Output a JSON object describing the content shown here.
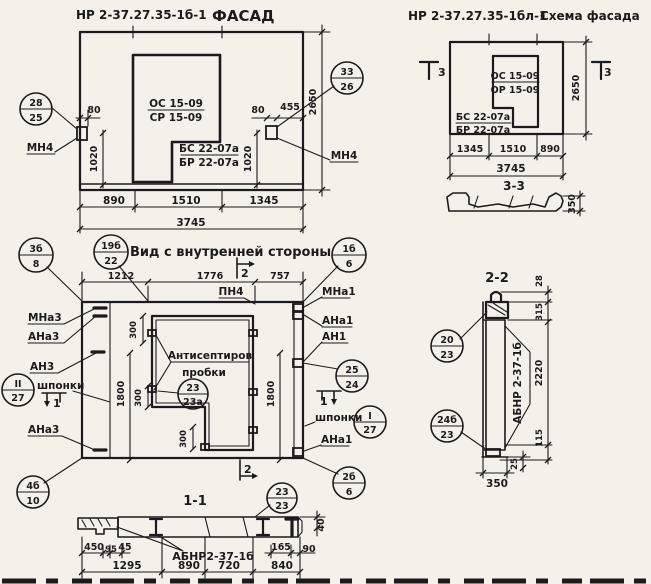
{
  "facade": {
    "mark": "НР 2-37.27.35-1б-1",
    "name": "ФАСАД",
    "win_a": "ОС 15-09",
    "win_b": "СР 15-09",
    "sill_a": "БС 22-07а",
    "sill_b": "БР 22-07а",
    "mn4_l": "МН4",
    "mn4_r": "МН4",
    "co_l_top": "28",
    "co_l_bot": "25",
    "co_r_top": "33",
    "co_r_bot": "26",
    "d80l": "80",
    "d1020l": "1020",
    "d80r": "80",
    "d455": "455",
    "d1020r": "1020",
    "d2650": "2650",
    "d890": "890",
    "d1510": "1510",
    "d1345": "1345",
    "d3745": "3745"
  },
  "scheme": {
    "mark": "НР 2-37.27.35-1бл-1",
    "name": "Схема фасада",
    "win_a": "ОС 15-09",
    "win_b": "ОР 15-09",
    "sill_a": "БС 22-07а",
    "sill_b": "БР 22-07а",
    "sec3": "3",
    "d2650": "2650",
    "d1345": "1345",
    "d1510": "1510",
    "d890": "890",
    "d3745": "3745"
  },
  "s33": {
    "title": "3-3",
    "d350": "350"
  },
  "inner": {
    "title": "Вид с внутренней стороны",
    "co_tl_top": "3б",
    "co_tl_bot": "8",
    "co_tm_top": "19б",
    "co_tm_bot": "22",
    "co_tr_top": "1б",
    "co_tr_bot": "6",
    "co_r_top": "25",
    "co_r_bot": "24",
    "co_kl_top": "II",
    "co_kl_bot": "27",
    "co_kr_top": "I",
    "co_kr_bot": "27",
    "co_bl_top": "4б",
    "co_bl_bot": "10",
    "co_br_top": "2б",
    "co_br_bot": "6",
    "co_plug_top": "23",
    "co_plug_bot": "23а",
    "mna3": "МНа3",
    "ana3": "АНа3",
    "an3": "АН3",
    "shp_l": "шпонки",
    "ana3b": "АНа3",
    "mna1": "МНа1",
    "ana1": "АНа1",
    "an1": "АН1",
    "shp_r": "шпонки",
    "ana1b": "АНа1",
    "pn4": "ПН4",
    "note1": "Антисептиров",
    "note2": "пробки",
    "s1": "1",
    "s2": "2",
    "d1212": "1212",
    "d1776": "1776",
    "d757": "757",
    "d1800": "1800",
    "d300": "300"
  },
  "s11": {
    "title": "1-1",
    "co_top": "23",
    "co_bot": "23",
    "mark": "АБНР2-37-1б",
    "d450": "450",
    "d95": "95",
    "d45": "45",
    "d165": "165",
    "d90": "90",
    "d40": "40",
    "d1295": "1295",
    "d890": "890",
    "d720": "720",
    "d840": "840"
  },
  "s22": {
    "title": "2-2",
    "co1_top": "20",
    "co1_bot": "23",
    "co2_top": "24б",
    "co2_bot": "23",
    "mark": "АБНР 2-37-1б",
    "d28": "28",
    "d315": "315",
    "d2220": "2220",
    "d115": "115",
    "d25": "25",
    "d350": "350"
  }
}
